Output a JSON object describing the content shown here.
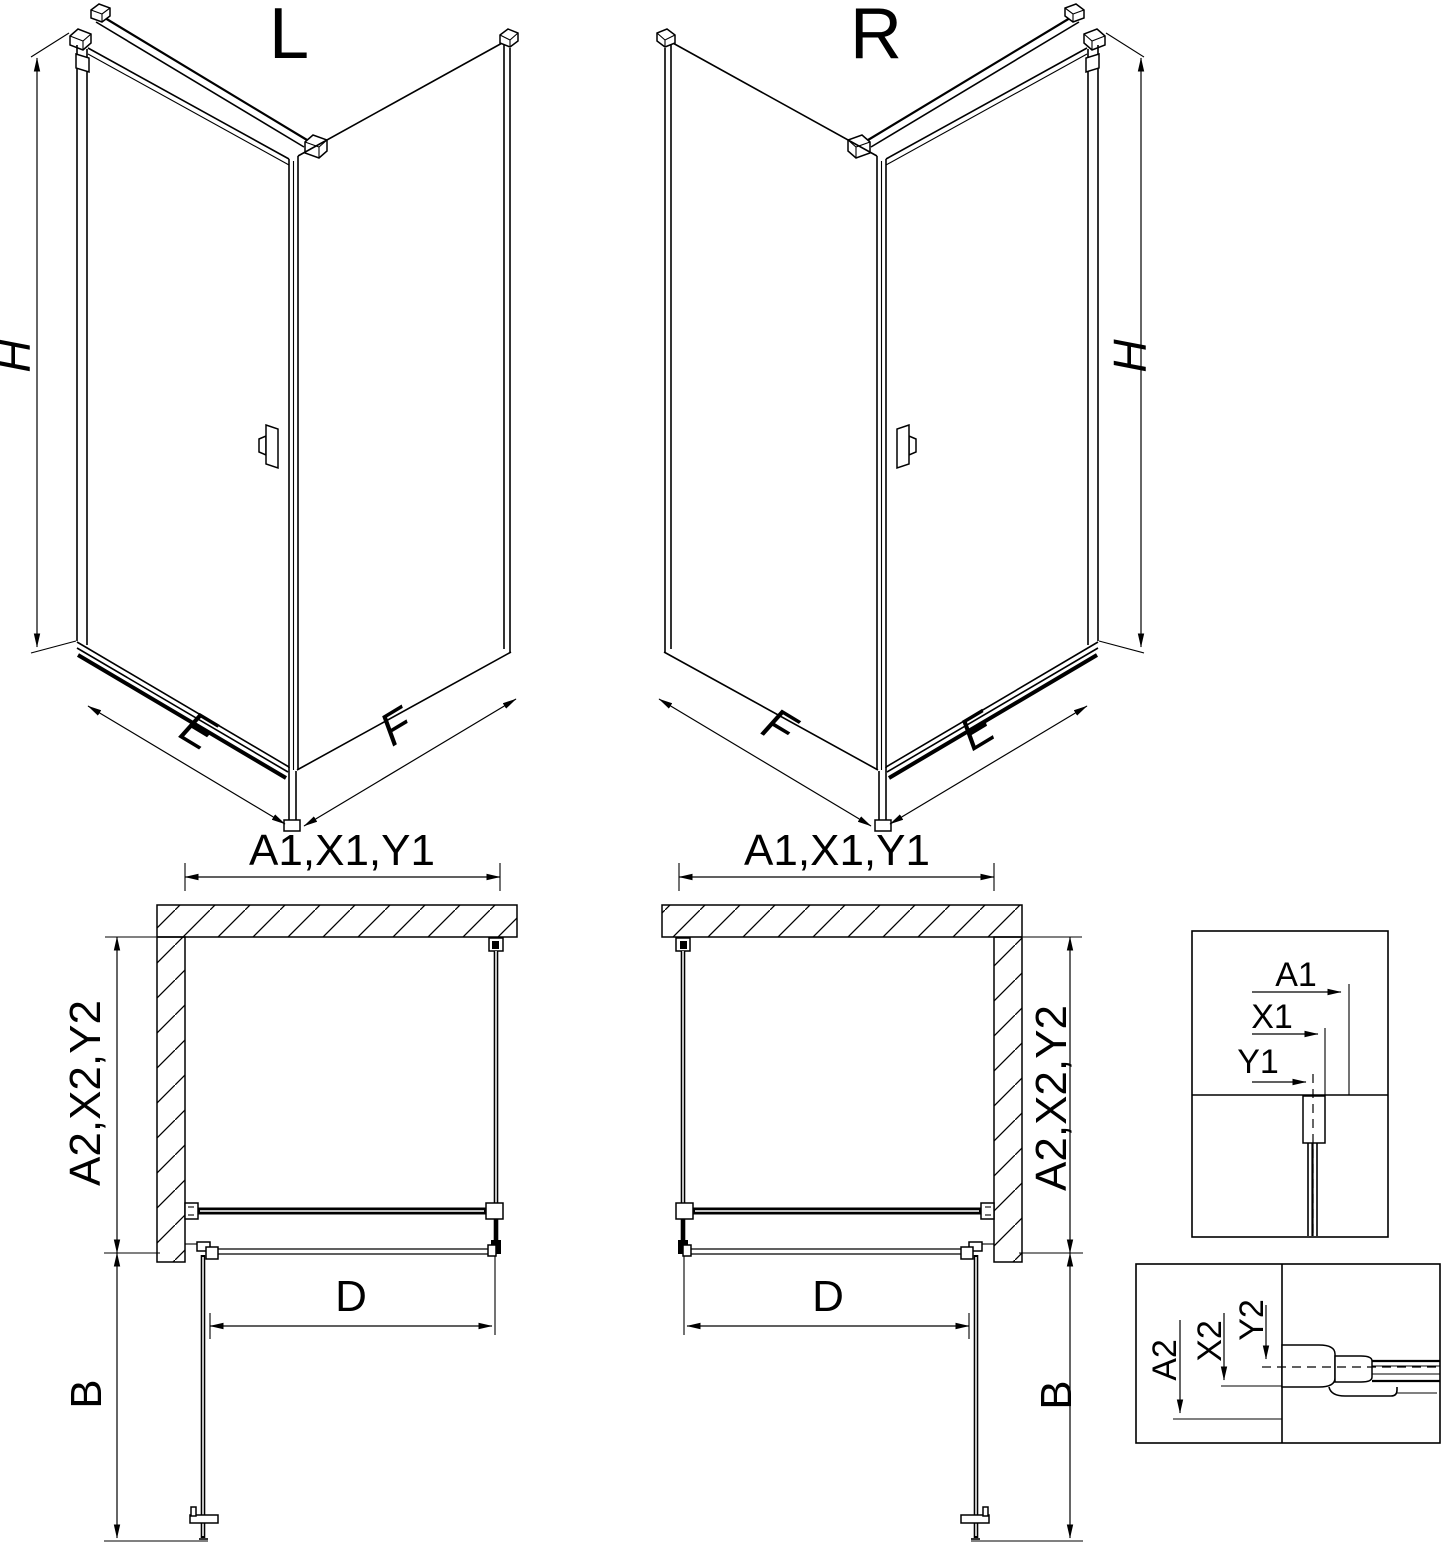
{
  "drawing": {
    "background": "#ffffff",
    "line_color": "#000000",
    "views": {
      "iso_left": {
        "title": "L",
        "dims": {
          "height": "H",
          "door_side": "E",
          "panel_side": "F"
        }
      },
      "iso_right": {
        "title": "R",
        "dims": {
          "height": "H",
          "door_side": "E",
          "panel_side": "F"
        }
      },
      "plan_left": {
        "dims": {
          "width_top": "A1,X1,Y1",
          "depth_side": "A2,X2,Y2",
          "opening": "D",
          "door_swing": "B"
        }
      },
      "plan_right": {
        "dims": {
          "width_top": "A1,X1,Y1",
          "depth_side": "A2,X2,Y2",
          "opening": "D",
          "door_swing": "B"
        }
      },
      "detail_top_profile": {
        "dims": {
          "a1": "A1",
          "x1": "X1",
          "y1": "Y1"
        }
      },
      "detail_side_profile": {
        "dims": {
          "a2": "A2",
          "x2": "X2",
          "y2": "Y2"
        }
      }
    }
  }
}
